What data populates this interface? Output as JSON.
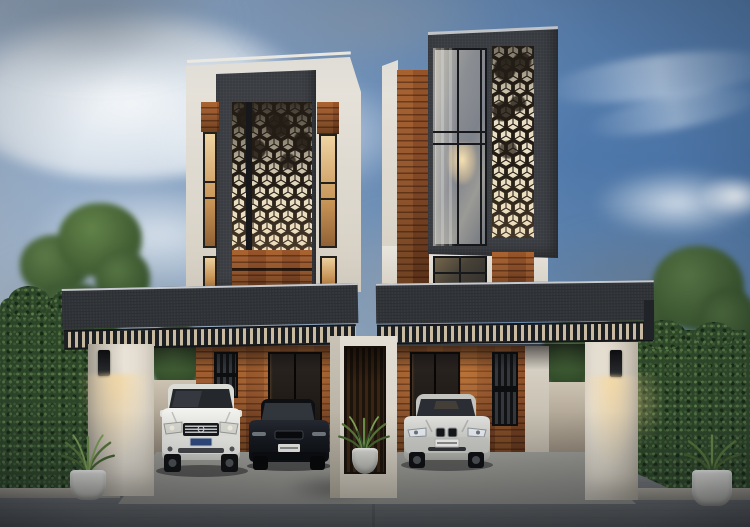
{
  "meta": {
    "domain": "Natural-Image",
    "description": "Dusk 3D architectural rendering of two symmetrical modern duplex townhouses: charcoal feature towers with laser-cut hexagonal pattern screens lit warmly from behind, tall glass picture window with chandelier, horizontal wood cladding, flat charcoal carport roofs with slatted fasciae, white pillars with downlight sconces, a white divider wall with a potted plant between the drives, three parked cars, clipped hedges, trees and a concrete street."
  },
  "palette": {
    "charcoal": "#383b40",
    "roof_dark": "#2c2f33",
    "roof_edge": "#c6c9cd",
    "fascia_slat": "#1d2023",
    "fascia_gap": "#c8bba2",
    "wood": "#8a4e2a",
    "wood_dark": "#5c331a",
    "wood_lit": "#a05a2c",
    "warm_window_hi": "#f0d6a6",
    "white_wall": "#e8e5de",
    "pillar_light": "#e9e3d7",
    "pillar_shade": "#b3aca0",
    "pattern_cream": "#eadfc4",
    "pattern_dark": "#221c15",
    "mullion": "#17191c",
    "glass": "#878b91",
    "hedge": "#2e4829",
    "tree": "#47653a",
    "street_hi": "#898b8d",
    "street_lo": "#515457",
    "driveway": "#94948f",
    "glow": "#f6d9a4",
    "suv_white": "#eaeae7",
    "sedan_dark": "#14171d",
    "bmw_silver": "#d0d1cd",
    "plant_green": "#5f7f40",
    "pot_white": "#dcdcd8",
    "sky_deep": "#4e7cb1",
    "sky_horizon": "#aeb8c2",
    "cloud_white": "#eef1f3",
    "cloud_gray": "#8b96a2"
  },
  "scene": {
    "left_house": {
      "elements": [
        "white-parapet",
        "charcoal-feature-tower",
        "hex-pattern-screen",
        "wood-cladding-band",
        "lit-slot-windows",
        "carport-roof",
        "slatted-fascia",
        "entry-door",
        "window-grille",
        "white-suv",
        "dark-sedan",
        "pillar",
        "wall-lamp"
      ]
    },
    "right_house": {
      "elements": [
        "white-parapet",
        "charcoal-feature-tower",
        "hex-pattern-screen",
        "picture-window",
        "chandelier",
        "wood-cladding-strip",
        "small-window",
        "carport-roof",
        "slatted-fascia",
        "entry-door",
        "window-grille",
        "silver-sedan",
        "pillar",
        "wall-lamp"
      ]
    },
    "middle": {
      "elements": [
        "white-divider-frame-wall",
        "wood-slat-backdrop",
        "potted-plant"
      ]
    },
    "environment": {
      "elements": [
        "dusk-sky",
        "clouds",
        "tree-left",
        "tree-right",
        "hedge-left",
        "hedge-right",
        "street",
        "driveway-left",
        "driveway-right",
        "planter-left",
        "planter-right",
        "curbs"
      ]
    }
  }
}
